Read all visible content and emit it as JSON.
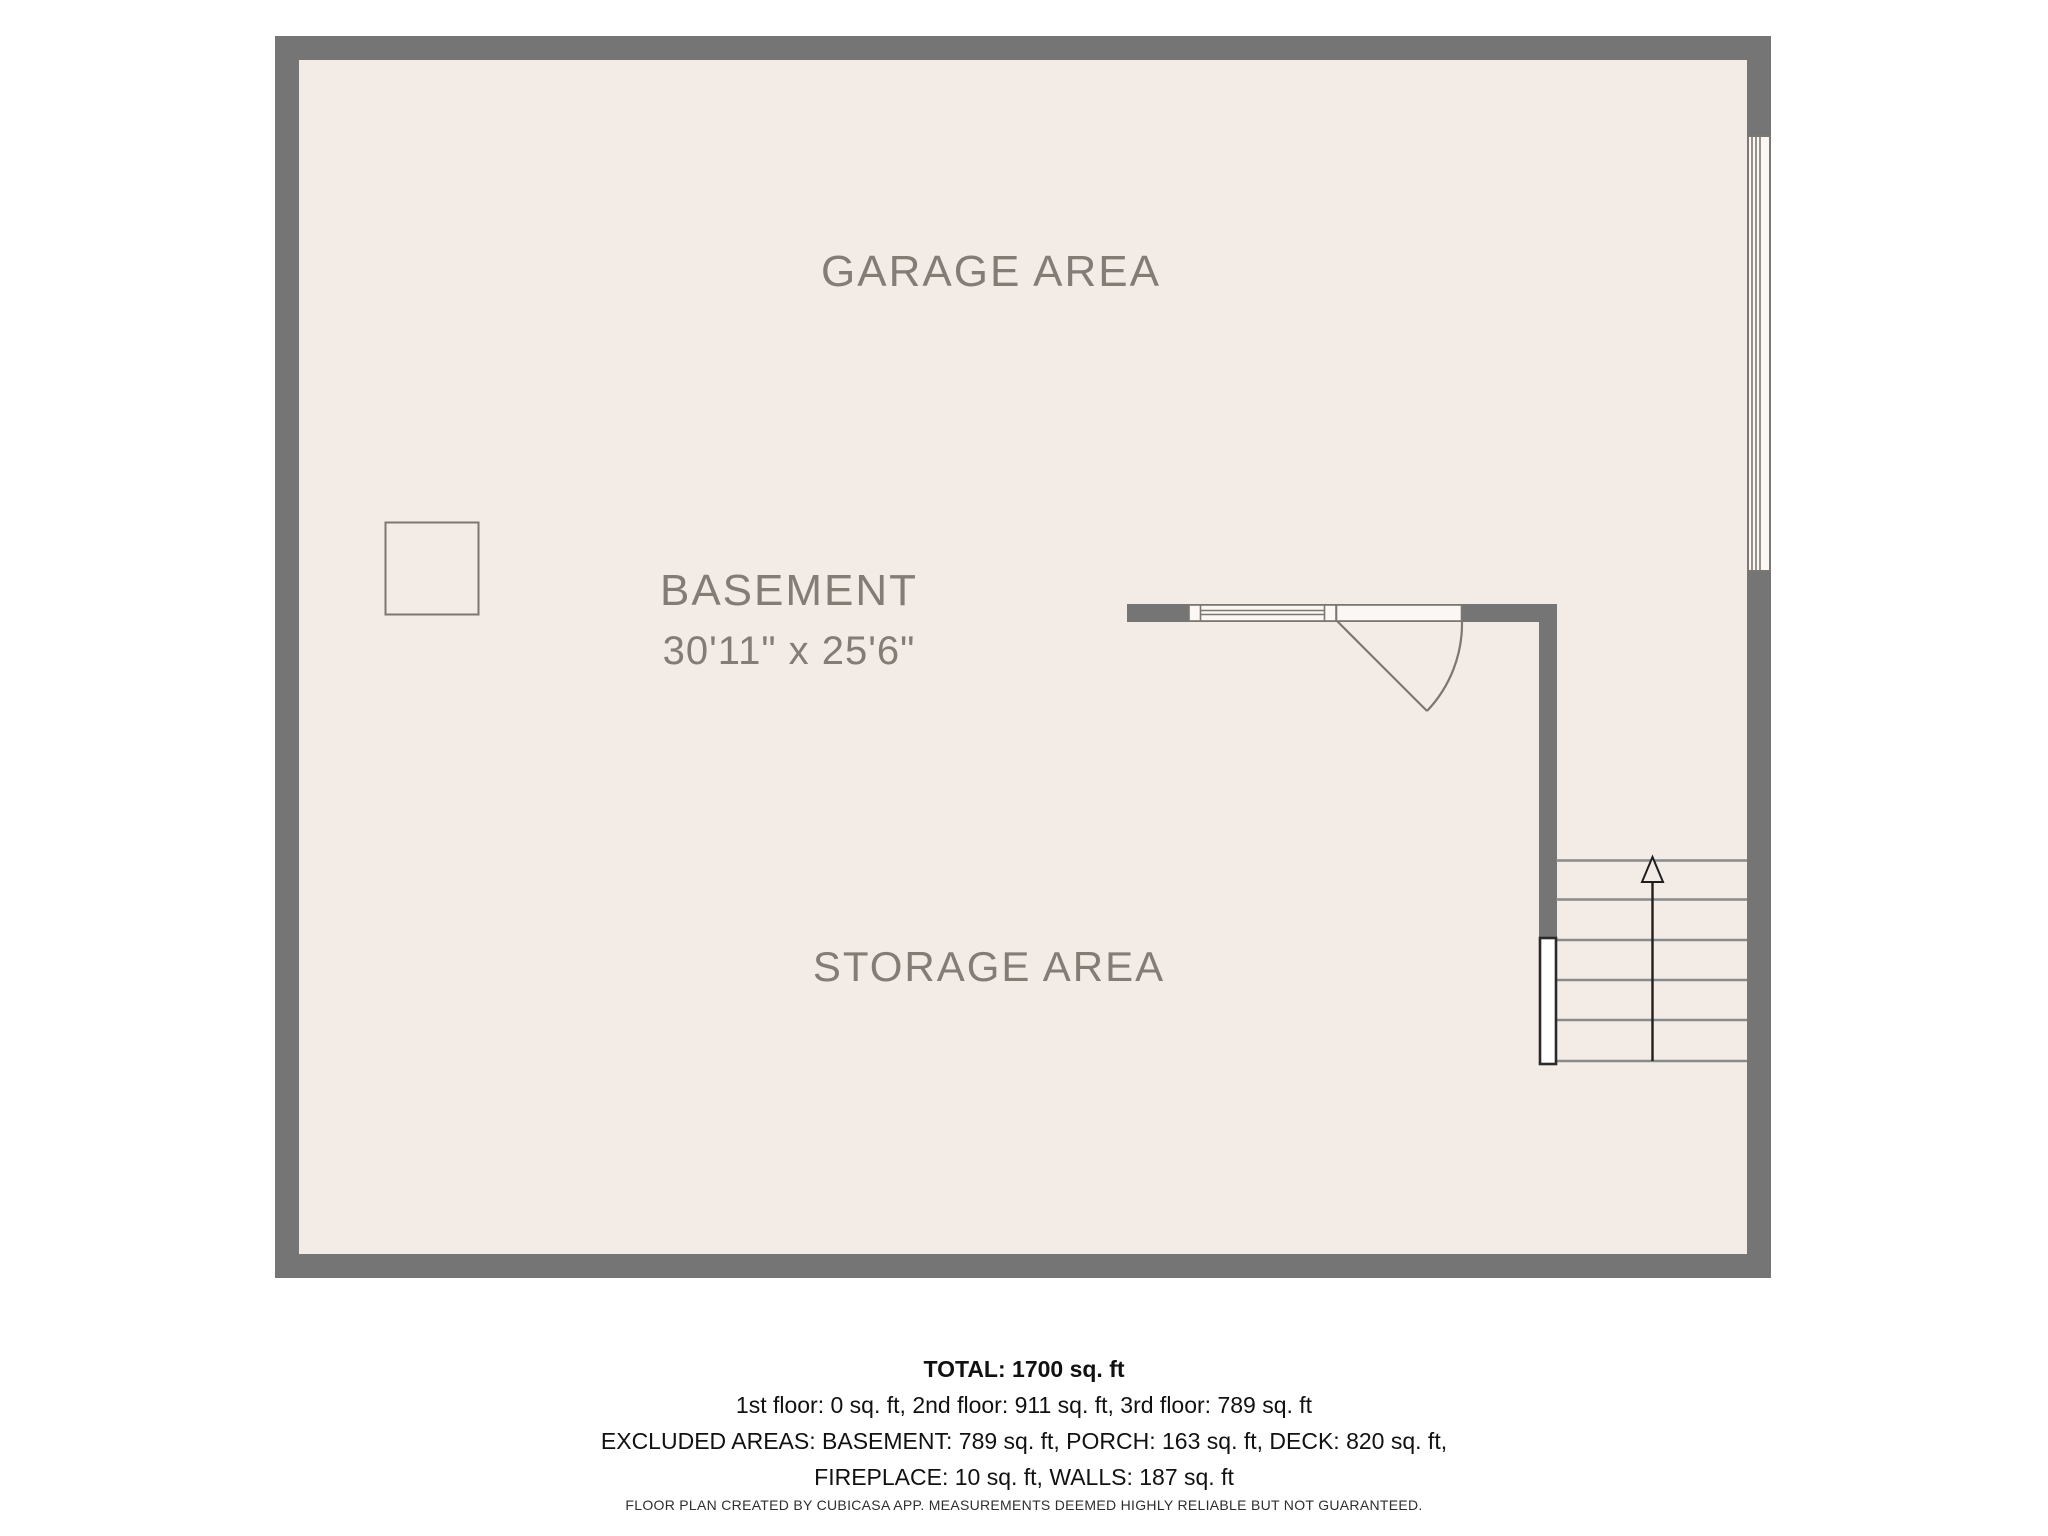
{
  "colors": {
    "wall": "#757575",
    "floor": "#F3ECE6",
    "room_label": "#837D76",
    "line": "#7C7770",
    "stair_line": "#8A8A8A",
    "dark_line": "#1F1F1F",
    "summary_text": "#111111",
    "disclaimer_text": "#2E2E2E",
    "page_background": "#FFFFFF"
  },
  "rooms": {
    "garage": {
      "label": "GARAGE AREA"
    },
    "basement": {
      "label": "BASEMENT",
      "dimensions": "30'11\" x 25'6\""
    },
    "storage": {
      "label": "STORAGE AREA"
    }
  },
  "features": {
    "stairs_direction": "up",
    "door_type": "single-swing",
    "window_count": 2,
    "column_count": 1
  },
  "summary": {
    "total": "TOTAL: 1700 sq. ft",
    "floors": "1st floor: 0 sq. ft, 2nd floor: 911 sq. ft, 3rd floor: 789 sq. ft",
    "excluded_line1": "EXCLUDED AREAS: BASEMENT: 789 sq. ft, PORCH: 163 sq. ft, DECK: 820 sq. ft,",
    "excluded_line2": "FIREPLACE: 10 sq. ft, WALLS: 187 sq. ft",
    "disclaimer": "FLOOR PLAN CREATED BY CUBICASA APP. MEASUREMENTS DEEMED HIGHLY RELIABLE BUT NOT GUARANTEED."
  }
}
